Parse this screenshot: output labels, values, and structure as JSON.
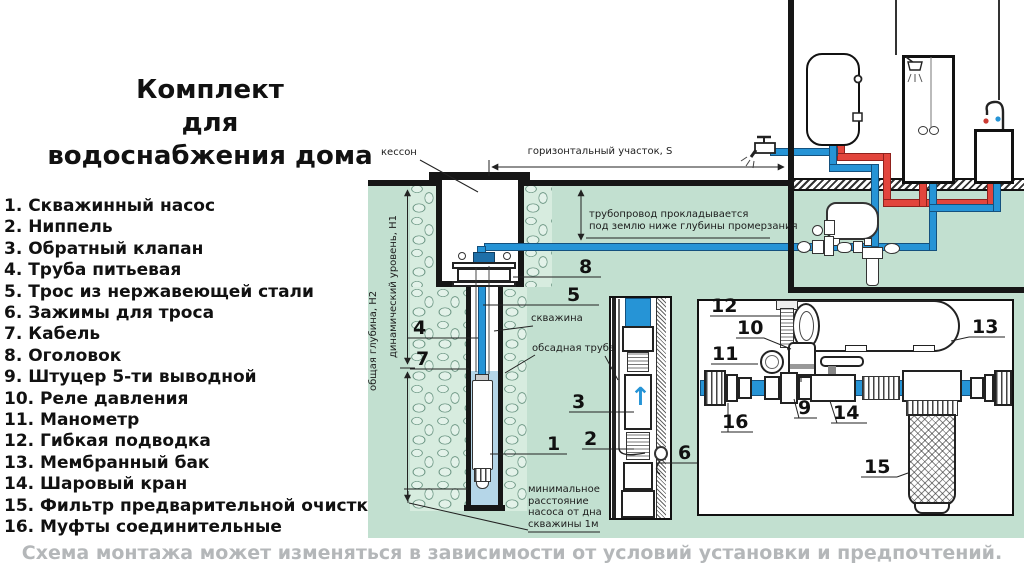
{
  "title": "Комплект\nдля\nводоснабжения дома",
  "legend": {
    "items": [
      "1. Скважинный насос",
      "2. Ниппель",
      "3. Обратный клапан",
      "4. Труба питьевая",
      "5. Трос из нержавеющей стали",
      "6. Зажимы для троса",
      "7. Кабель",
      "8. Оголовок",
      "9. Штуцер 5-ти выводной",
      "10. Реле давления",
      "11. Манометр",
      "12. Гибкая подводка",
      "13. Мембранный бак",
      "14. Шаровый кран",
      "15. Фильтр предварительной очистки",
      "16. Муфты соединительные"
    ]
  },
  "footer": "Схема монтажа может изменяться в зависимости от условий установки и предпочтений.",
  "diagram": {
    "labels": {
      "kesson": "кессон",
      "horizontal_section": "горизонтальный участок, S",
      "frost": "трубопровод прокладывается\nпод землю ниже глубины промерзания",
      "total_depth": "общая глубина, H2",
      "dynamic_level": "динамический уровень, H1",
      "borehole": "скважина",
      "casing": "обсадная труба",
      "min_distance": "минимальное\nрасстояние\nнасоса от дна\nскважины 1м"
    },
    "callouts": {
      "c1": "1",
      "c2": "2",
      "c3": "3",
      "c4": "4",
      "c5": "5",
      "c6": "6",
      "c7": "7",
      "c8": "8",
      "c9": "9",
      "c10": "10",
      "c11": "11",
      "c12": "12",
      "c13": "13",
      "c14": "14",
      "c15": "15",
      "c16": "16"
    },
    "valve_arrow": "↑",
    "colors": {
      "cold_pipe": "#2694d6",
      "hot_pipe": "#e2453c",
      "underground": "#c2e0d0",
      "well_water": "#b5d6e8",
      "note_gray": "#b4b7b9"
    }
  }
}
